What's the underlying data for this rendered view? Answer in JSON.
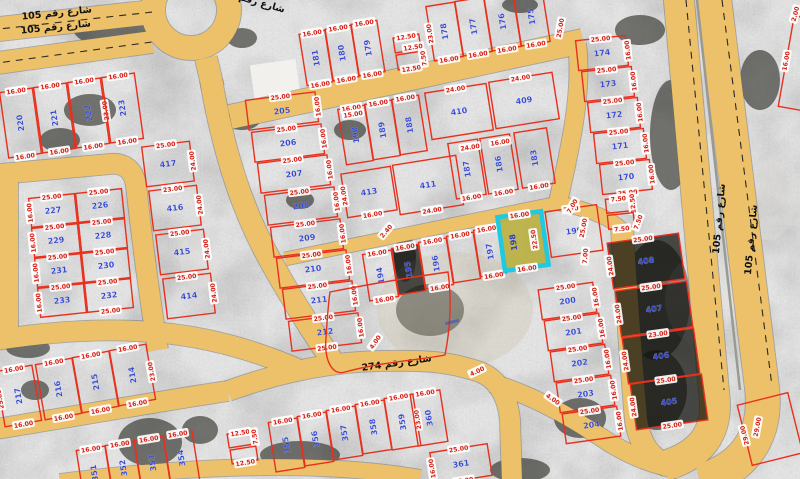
{
  "map": {
    "colors": {
      "road": "#ecc169",
      "road_edge": "#6b6b66",
      "lane_dash": "#2a2a26",
      "parcel_line": "#e8301e",
      "parcel_number": "#2b3fd0",
      "dim_text": "#d42015",
      "dim_bg": "#ffffff",
      "selected_stroke": "#1ec9e2",
      "selected_fill": "#b9ae3c",
      "street_text": "#111111",
      "background": "#8f8f8d"
    },
    "streets": [
      {
        "name": "شارع رقم 105",
        "x": 57,
        "y": 16,
        "rot": -6
      },
      {
        "name": "شارع رقم 105",
        "x": 56,
        "y": 30,
        "rot": -6
      },
      {
        "name": "شارع رقم 105",
        "x": 250,
        "y": 3,
        "rot": 16
      },
      {
        "name": "شارع رقم 274",
        "x": 397,
        "y": 366,
        "rot": -8
      },
      {
        "name": "شارع رقم 105",
        "x": 722,
        "y": 219,
        "rot": -85
      },
      {
        "name": "شارع رقم 105",
        "x": 754,
        "y": 240,
        "rot": -85
      }
    ],
    "selected": {
      "number": "198",
      "x": 501,
      "y": 214,
      "w": 44,
      "h": 54,
      "r": -8,
      "dim_top": "16.00",
      "dim_side": "22.50",
      "dim_bottom": "16.00"
    },
    "parcels": [
      {
        "n": "220",
        "x": 4,
        "y": 90,
        "w": 33,
        "h": 66,
        "r": -8,
        "v": 1,
        "dt": "16.00",
        "db": "16.00"
      },
      {
        "n": "221",
        "x": 38,
        "y": 85,
        "w": 33,
        "h": 66,
        "r": -8,
        "v": 1,
        "dt": "16.00",
        "db": "16.00"
      },
      {
        "n": "222",
        "x": 72,
        "y": 80,
        "w": 33,
        "h": 66,
        "r": -8,
        "v": 1,
        "dt": "16.00",
        "db": "16.00",
        "ds": "23.00"
      },
      {
        "n": "223",
        "x": 106,
        "y": 75,
        "w": 33,
        "h": 66,
        "r": -8,
        "v": 1,
        "dt": "16.00",
        "db": "16.00"
      },
      {
        "n": "227",
        "x": 30,
        "y": 196,
        "w": 46,
        "h": 29,
        "r": -6,
        "dt": "25.00",
        "dsl": "16.00"
      },
      {
        "n": "226",
        "x": 77,
        "y": 191,
        "w": 46,
        "h": 29,
        "r": -6,
        "dt": "25.00"
      },
      {
        "n": "229",
        "x": 33,
        "y": 226,
        "w": 46,
        "h": 29,
        "r": -6,
        "dt": "25.00",
        "dsl": "16.00"
      },
      {
        "n": "228",
        "x": 80,
        "y": 221,
        "w": 46,
        "h": 29,
        "r": -6,
        "dt": "25.00"
      },
      {
        "n": "231",
        "x": 36,
        "y": 256,
        "w": 46,
        "h": 29,
        "r": -6,
        "dt": "25.00",
        "dsl": "16.00"
      },
      {
        "n": "230",
        "x": 83,
        "y": 251,
        "w": 46,
        "h": 29,
        "r": -6,
        "dt": "25.00"
      },
      {
        "n": "233",
        "x": 39,
        "y": 286,
        "w": 46,
        "h": 29,
        "r": -6,
        "dt": "25.00",
        "dsl": "16.00"
      },
      {
        "n": "232",
        "x": 86,
        "y": 281,
        "w": 46,
        "h": 29,
        "r": -6,
        "dt": "25.00",
        "db": "25.00"
      },
      {
        "n": "417",
        "x": 144,
        "y": 144,
        "w": 48,
        "h": 40,
        "r": -7,
        "dt": "25.00",
        "ds": "24.00"
      },
      {
        "n": "416",
        "x": 151,
        "y": 188,
        "w": 48,
        "h": 40,
        "r": -7,
        "dt": "23.00",
        "ds": "24.00"
      },
      {
        "n": "415",
        "x": 158,
        "y": 232,
        "w": 48,
        "h": 40,
        "r": -7,
        "dt": "25.00",
        "ds": "24.00"
      },
      {
        "n": "414",
        "x": 165,
        "y": 276,
        "w": 48,
        "h": 40,
        "r": -7,
        "dt": "25.00",
        "ds": "24.00"
      },
      {
        "n": "205",
        "x": 247,
        "y": 96,
        "w": 70,
        "h": 30,
        "r": -7,
        "dt": "25.00",
        "ds": "16.00"
      },
      {
        "n": "206",
        "x": 253,
        "y": 128,
        "w": 70,
        "h": 30,
        "r": -7,
        "dt": "25.00",
        "ds": "16.00"
      },
      {
        "n": "207",
        "x": 259,
        "y": 159,
        "w": 70,
        "h": 30,
        "r": -7,
        "dt": "25.00",
        "ds": "16.00"
      },
      {
        "n": "208",
        "x": 266,
        "y": 191,
        "w": 70,
        "h": 30,
        "r": -7,
        "dt": "25.00",
        "ds": "16.00"
      },
      {
        "n": "209",
        "x": 272,
        "y": 223,
        "w": 70,
        "h": 30,
        "r": -7,
        "dt": "25.00",
        "ds": "16.00"
      },
      {
        "n": "210",
        "x": 278,
        "y": 254,
        "w": 70,
        "h": 30,
        "r": -7,
        "dt": "25.00",
        "ds": "16.00"
      },
      {
        "n": "211",
        "x": 284,
        "y": 285,
        "w": 70,
        "h": 30,
        "r": -7,
        "dt": "25.00",
        "ds": "16.00"
      },
      {
        "n": "212",
        "x": 290,
        "y": 317,
        "w": 70,
        "h": 30,
        "r": -7,
        "dt": "25.00",
        "ds": "16.00",
        "db": "25.00"
      },
      {
        "n": "181",
        "x": 303,
        "y": 32,
        "w": 26,
        "h": 52,
        "r": -9,
        "v": 1,
        "dt": "16.00",
        "db": "16.00"
      },
      {
        "n": "180",
        "x": 329,
        "y": 27,
        "w": 26,
        "h": 52,
        "r": -9,
        "v": 1,
        "dt": "16.00",
        "db": "16.00"
      },
      {
        "n": "179",
        "x": 355,
        "y": 22,
        "w": 26,
        "h": 52,
        "r": -9,
        "v": 1,
        "dt": "16.00",
        "db": "16.00"
      },
      {
        "n": "",
        "x": 394,
        "y": 36,
        "w": 26,
        "h": 15,
        "r": -9,
        "dt": "12.50"
      },
      {
        "n": "",
        "x": 397,
        "y": 53,
        "w": 26,
        "h": 15,
        "r": -9,
        "db": "12.50",
        "ds": "7.50"
      },
      {
        "n": "178",
        "x": 430,
        "y": 4,
        "w": 29,
        "h": 55,
        "r": -9,
        "v": 1,
        "db": "16.00",
        "dsl": "23.00"
      },
      {
        "n": "177",
        "x": 459,
        "y": -1,
        "w": 29,
        "h": 55,
        "r": -9,
        "v": 1,
        "db": "16.00"
      },
      {
        "n": "176",
        "x": 488,
        "y": -6,
        "w": 29,
        "h": 55,
        "r": -9,
        "v": 1,
        "db": "16.00"
      },
      {
        "n": "175",
        "x": 517,
        "y": -11,
        "w": 29,
        "h": 55,
        "r": -9,
        "v": 1,
        "db": "16.00"
      },
      {
        "n": "174",
        "x": 577,
        "y": 38,
        "w": 50,
        "h": 30,
        "r": -6,
        "dt": "25.00",
        "ds": "16.00"
      },
      {
        "n": "173",
        "x": 583,
        "y": 69,
        "w": 50,
        "h": 30,
        "r": -6,
        "dt": "25.00",
        "ds": "16.00"
      },
      {
        "n": "172",
        "x": 589,
        "y": 100,
        "w": 50,
        "h": 30,
        "r": -6,
        "dt": "25.00",
        "ds": "16.00"
      },
      {
        "n": "171",
        "x": 595,
        "y": 131,
        "w": 50,
        "h": 30,
        "r": -6,
        "dt": "25.00",
        "ds": "16.00"
      },
      {
        "n": "170",
        "x": 601,
        "y": 162,
        "w": 50,
        "h": 30,
        "r": -6,
        "dt": "25.00",
        "ds": "16.00",
        "db": "25.00"
      },
      {
        "n": "",
        "x": 606,
        "y": 198,
        "w": 26,
        "h": 14,
        "r": -6,
        "dt": "7.50",
        "ds": "12.50"
      },
      {
        "n": "",
        "x": 608,
        "y": 214,
        "w": 26,
        "h": 14,
        "r": -6,
        "db": "7.50"
      },
      {
        "n": "190",
        "x": 342,
        "y": 107,
        "w": 27,
        "h": 56,
        "r": -9,
        "v": 1,
        "dt": "16.00"
      },
      {
        "n": "189",
        "x": 369,
        "y": 102,
        "w": 27,
        "h": 56,
        "r": -9,
        "v": 1,
        "dt": "16.00"
      },
      {
        "n": "188",
        "x": 396,
        "y": 97,
        "w": 27,
        "h": 56,
        "r": -9,
        "v": 1,
        "dt": "16.00"
      },
      {
        "n": "410",
        "x": 428,
        "y": 88,
        "w": 62,
        "h": 47,
        "r": -9,
        "dt": "24.00"
      },
      {
        "n": "409",
        "x": 492,
        "y": 77,
        "w": 64,
        "h": 47,
        "r": -9,
        "dt": "24.00"
      },
      {
        "n": "413",
        "x": 344,
        "y": 170,
        "w": 50,
        "h": 44,
        "r": -9,
        "db": "16.00",
        "dsl": "24.00"
      },
      {
        "n": "411",
        "x": 396,
        "y": 160,
        "w": 64,
        "h": 50,
        "r": -9,
        "db": "24.00"
      },
      {
        "n": "187",
        "x": 452,
        "y": 141,
        "w": 30,
        "h": 56,
        "r": -9,
        "v": 1,
        "db": "16.00"
      },
      {
        "n": "186",
        "x": 484,
        "y": 136,
        "w": 30,
        "h": 56,
        "r": -9,
        "v": 1,
        "db": "16.00"
      },
      {
        "n": "183",
        "x": 518,
        "y": 130,
        "w": 33,
        "h": 56,
        "r": -9,
        "v": 1,
        "db": "16.00"
      },
      {
        "n": "194",
        "x": 366,
        "y": 252,
        "w": 29,
        "h": 47,
        "r": -9,
        "v": 1,
        "dt": "16.00",
        "db": "16.00"
      },
      {
        "n": "195",
        "x": 395,
        "y": 246,
        "w": 27,
        "h": 47,
        "r": -9,
        "v": 1,
        "dark": 1,
        "dt": "16.00"
      },
      {
        "n": "196",
        "x": 422,
        "y": 240,
        "w": 28,
        "h": 47,
        "r": -9,
        "v": 1,
        "dt": "16.00",
        "db": "16.00"
      },
      {
        "n": "",
        "x": 450,
        "y": 234,
        "w": 27,
        "h": 47,
        "r": -9,
        "dt": "16.00"
      },
      {
        "n": "197",
        "x": 477,
        "y": 228,
        "w": 26,
        "h": 47,
        "r": -9,
        "v": 1,
        "dt": "16.00",
        "db": "16.00"
      },
      {
        "n": "199",
        "x": 548,
        "y": 208,
        "w": 52,
        "h": 46,
        "r": -8,
        "dt": "7.00"
      },
      {
        "n": "200",
        "x": 540,
        "y": 286,
        "w": 55,
        "h": 30,
        "r": -8,
        "dt": "25.00",
        "ds": "16.00"
      },
      {
        "n": "201",
        "x": 546,
        "y": 317,
        "w": 55,
        "h": 30,
        "r": -8,
        "dt": "25.00",
        "ds": "16.00"
      },
      {
        "n": "202",
        "x": 552,
        "y": 348,
        "w": 55,
        "h": 30,
        "r": -8,
        "dt": "25.00",
        "ds": "16.00"
      },
      {
        "n": "203",
        "x": 558,
        "y": 379,
        "w": 55,
        "h": 30,
        "r": -8,
        "dt": "25.00",
        "ds": "16.00"
      },
      {
        "n": "204",
        "x": 564,
        "y": 410,
        "w": 55,
        "h": 30,
        "r": -8,
        "dt": "25.00",
        "ds": "16.00"
      },
      {
        "n": "408",
        "x": 610,
        "y": 238,
        "w": 72,
        "h": 46,
        "r": -8,
        "dark": 1,
        "dt": "25.00",
        "dsl": "24.00"
      },
      {
        "n": "407",
        "x": 618,
        "y": 286,
        "w": 72,
        "h": 46,
        "r": -8,
        "dark": 1,
        "dt": "25.00",
        "dsl": "24.00"
      },
      {
        "n": "406",
        "x": 625,
        "y": 333,
        "w": 72,
        "h": 46,
        "r": -8,
        "dark": 1,
        "dt": "23.00",
        "dsl": "24.00"
      },
      {
        "n": "405",
        "x": 633,
        "y": 379,
        "w": 72,
        "h": 46,
        "r": -8,
        "dark": 1,
        "dt": "25.00",
        "dsl": "24.00",
        "db": "25.00"
      },
      {
        "n": "217",
        "x": 0,
        "y": 368,
        "w": 37,
        "h": 56,
        "r": -10,
        "v": 1,
        "dt": "16.00",
        "db": "16.00",
        "dsl": "25.00"
      },
      {
        "n": "216",
        "x": 40,
        "y": 361,
        "w": 37,
        "h": 56,
        "r": -10,
        "v": 1,
        "dt": "16.00",
        "db": "16.00"
      },
      {
        "n": "215",
        "x": 77,
        "y": 354,
        "w": 37,
        "h": 56,
        "r": -10,
        "v": 1,
        "dt": "16.00",
        "db": "16.00"
      },
      {
        "n": "214",
        "x": 114,
        "y": 347,
        "w": 37,
        "h": 56,
        "r": -10,
        "v": 1,
        "dt": "16.00",
        "db": "16.00",
        "ds": "23.00"
      },
      {
        "n": "351",
        "x": 80,
        "y": 448,
        "w": 29,
        "h": 50,
        "r": -9,
        "v": 1,
        "dt": "16.00"
      },
      {
        "n": "352",
        "x": 109,
        "y": 443,
        "w": 29,
        "h": 50,
        "r": -9,
        "v": 1,
        "dt": "16.00"
      },
      {
        "n": "353",
        "x": 138,
        "y": 438,
        "w": 29,
        "h": 50,
        "r": -9,
        "v": 1,
        "dt": "16.00"
      },
      {
        "n": "354",
        "x": 167,
        "y": 433,
        "w": 29,
        "h": 50,
        "r": -9,
        "v": 1,
        "dt": "16.00"
      },
      {
        "n": "",
        "x": 228,
        "y": 432,
        "w": 26,
        "h": 14,
        "r": -9,
        "dt": "12.50",
        "ds": "7.50"
      },
      {
        "n": "",
        "x": 231,
        "y": 448,
        "w": 26,
        "h": 14,
        "r": -9,
        "db": "12.50"
      },
      {
        "n": "355",
        "x": 272,
        "y": 420,
        "w": 29,
        "h": 50,
        "r": -9,
        "v": 1,
        "dt": "16.00"
      },
      {
        "n": "356",
        "x": 301,
        "y": 414,
        "w": 29,
        "h": 50,
        "r": -9,
        "v": 1,
        "dt": "16.00"
      },
      {
        "n": "357",
        "x": 330,
        "y": 408,
        "w": 29,
        "h": 50,
        "r": -9,
        "v": 1,
        "dt": "16.00"
      },
      {
        "n": "358",
        "x": 359,
        "y": 402,
        "w": 29,
        "h": 50,
        "r": -9,
        "v": 1,
        "dt": "16.00"
      },
      {
        "n": "359",
        "x": 388,
        "y": 396,
        "w": 29,
        "h": 52,
        "r": -9,
        "v": 1,
        "dt": "16.00",
        "ds": "23.00"
      },
      {
        "n": "360",
        "x": 414,
        "y": 392,
        "w": 30,
        "h": 52,
        "r": -9,
        "v": 1,
        "dt": "16.00"
      },
      {
        "n": "361",
        "x": 432,
        "y": 448,
        "w": 58,
        "h": 32,
        "r": -9,
        "dt": "25.00",
        "db": "25.00",
        "dsl": "16.00"
      },
      {
        "n": "",
        "x": 786,
        "y": 18,
        "w": 34,
        "h": 92,
        "r": 10,
        "dsl": "16.00"
      },
      {
        "n": "",
        "x": 744,
        "y": 398,
        "w": 52,
        "h": 62,
        "r": -14,
        "dsl": "29.00"
      }
    ],
    "extra_dims": [
      {
        "t": "25.00",
        "x": 560,
        "y": 28,
        "r": -80
      },
      {
        "t": "7.00",
        "x": 572,
        "y": 206,
        "r": -60
      },
      {
        "t": "25.00",
        "x": 583,
        "y": 228,
        "r": -80
      },
      {
        "t": "7.00",
        "x": 585,
        "y": 256,
        "r": -85
      },
      {
        "t": "4.00",
        "x": 375,
        "y": 342,
        "r": -55
      },
      {
        "t": "4.00",
        "x": 477,
        "y": 371,
        "r": -25
      },
      {
        "t": "4.00",
        "x": 553,
        "y": 399,
        "r": 35
      },
      {
        "t": "24.00",
        "x": 470,
        "y": 147,
        "r": -9
      },
      {
        "t": "16.00",
        "x": 500,
        "y": 142,
        "r": -9
      },
      {
        "t": "15.00",
        "x": 353,
        "y": 114,
        "r": -9
      },
      {
        "t": "2.40",
        "x": 386,
        "y": 231,
        "r": -50
      },
      {
        "t": "2.00",
        "x": 795,
        "y": 14,
        "r": -75
      },
      {
        "t": "29.00",
        "x": 757,
        "y": 427,
        "r": -80
      },
      {
        "t": "12.50",
        "x": 413,
        "y": 47,
        "r": -9
      },
      {
        "t": "7.50",
        "x": 638,
        "y": 222,
        "r": -70
      }
    ],
    "illegible_label": {
      "x": 452,
      "y": 322
    }
  }
}
